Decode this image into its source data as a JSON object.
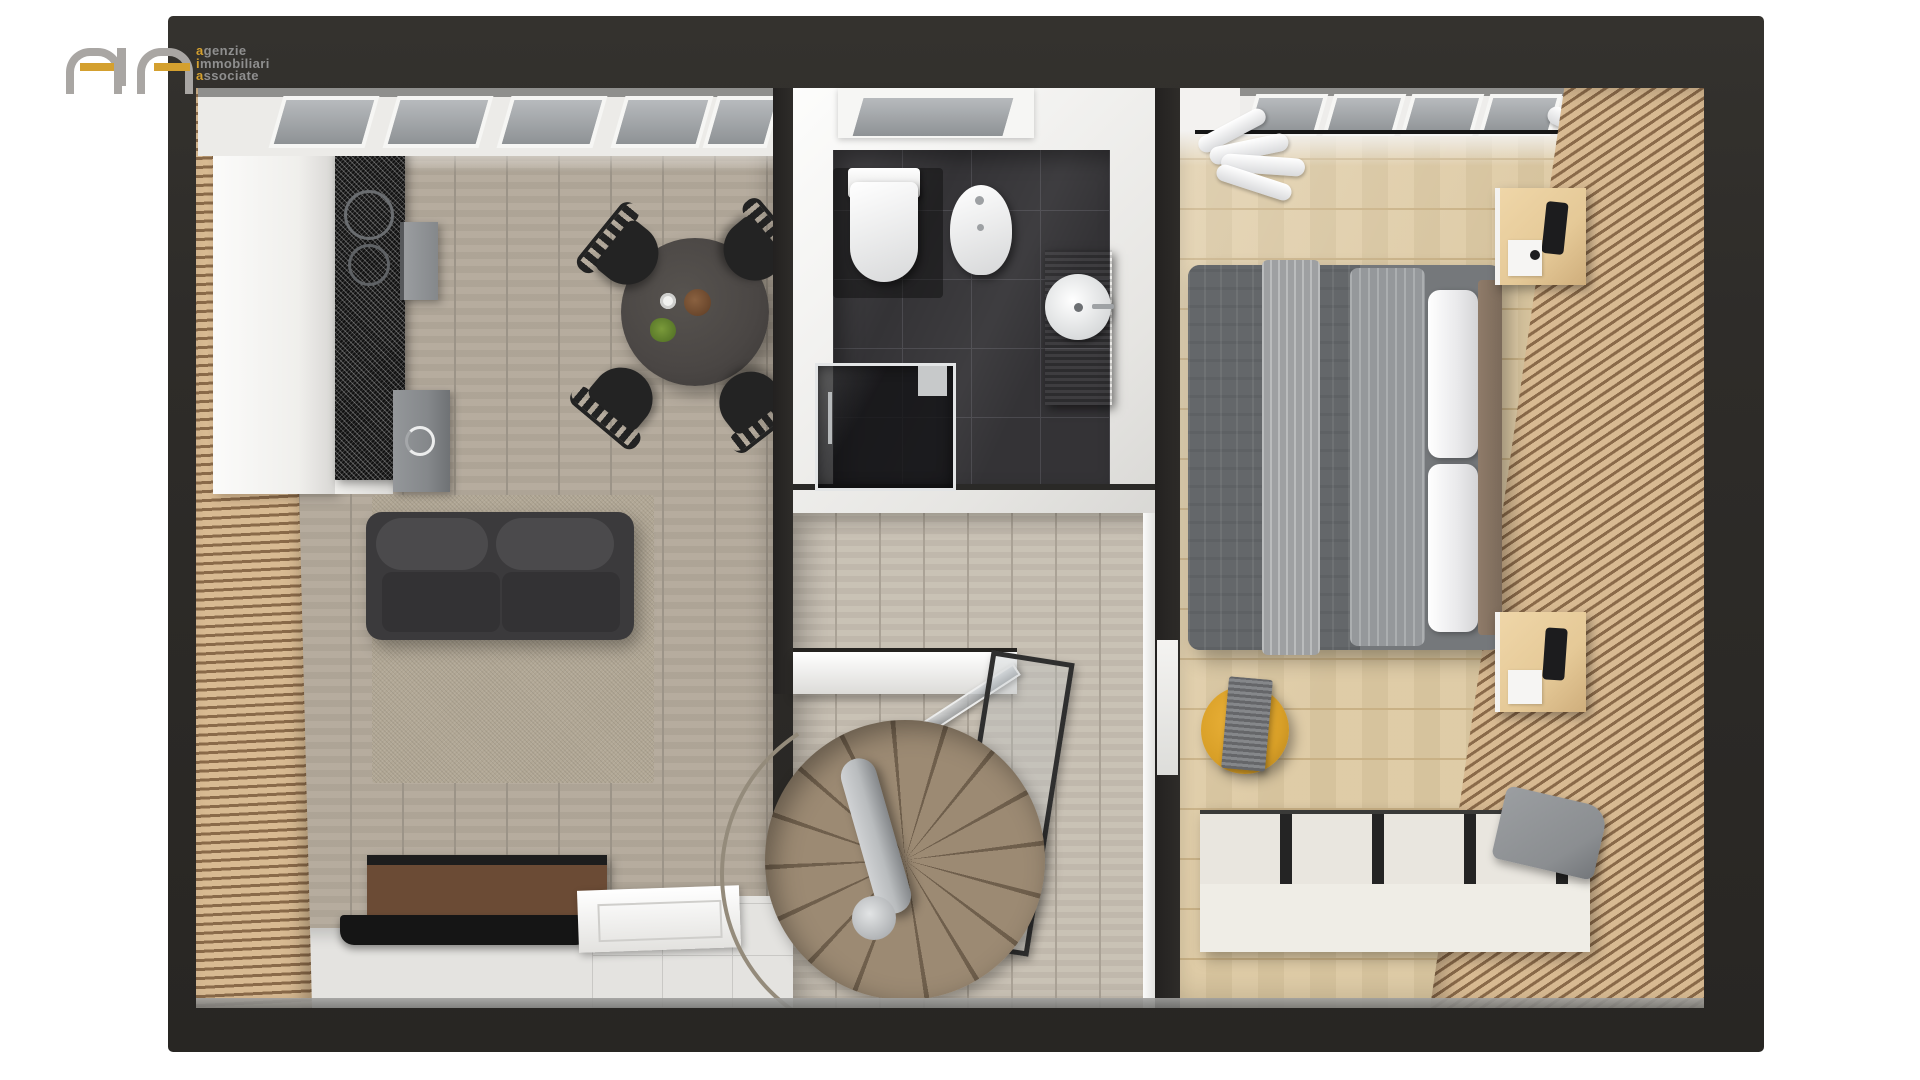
{
  "logo": {
    "lines": [
      {
        "first": "a",
        "rest": "genzie"
      },
      {
        "first": "i",
        "rest": "mmobiliari"
      },
      {
        "first": "a",
        "rest": "ssociate"
      }
    ]
  },
  "palette": {
    "page_bg": "#ffffff",
    "wall_dark": "#2e2c29",
    "white_wall": "#f2f1ee",
    "entry_floor": "#e4e3e0",
    "slat_wood": "#d8ba92",
    "slat_gap": "#8a6a49",
    "living_floor": "#b3a99b",
    "living_line": "#9c9488",
    "hall_floor": "#c7bfb2",
    "hall_line": "#aaa296",
    "bed_floor": "#ddc9a2",
    "bed_line": "#c9b185",
    "bath_tile": "#343336",
    "bath_line": "#4a494e",
    "rug": "#b1a795",
    "sofa": "#3b3a3c",
    "sofa_cushion": "#4b4a4c",
    "sofa_seat": "#333234",
    "table": "#4a4644",
    "chair": "#232323",
    "cabinet": "#f0efec",
    "counter": "#121212",
    "appliance": "#85888b",
    "sideboard": "#6b4b35",
    "tv": "#151515",
    "duvet": "#75787b",
    "duvet_dark": "#64676a",
    "blanket": "#a7a9ab",
    "pillow_white": "#e9e9eb",
    "headboard": "#8f7b69",
    "nightstand": "#e5c997",
    "phone": "#1c1c1e",
    "pouf": "#d89f27",
    "throw": "#7b7d80",
    "bench": "#e9e6df",
    "bench_slat": "#242424",
    "tray": "#8b8e91",
    "stair_wood": "#9c8a73",
    "stair_gap": "#6f5f4c",
    "pole": "#b9bcbe",
    "handrail": "#948b7b",
    "pane": "#8e9295",
    "frame_white": "#f6f6f4",
    "gold": "#d4a02f",
    "logo_gray": "#8f8f8f",
    "logo_arch": "#a9a6a3"
  }
}
